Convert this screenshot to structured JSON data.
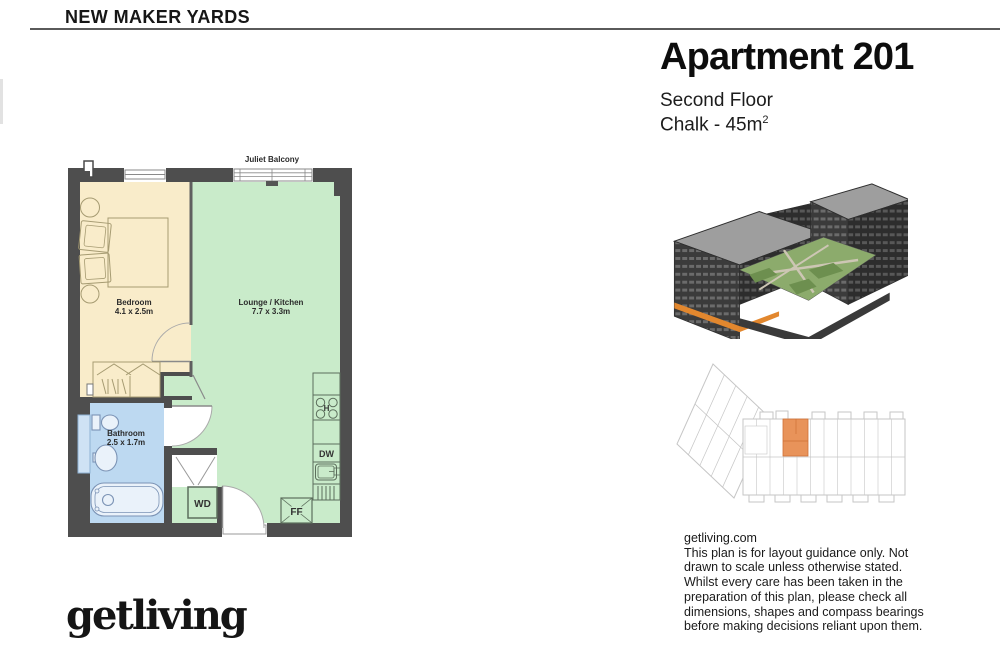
{
  "header": {
    "site_name": "NEW MAKER YARDS"
  },
  "apartment": {
    "title": "Apartment 201",
    "floor": "Second Floor",
    "unit_type": "Chalk - 45m",
    "area_exponent": "2"
  },
  "floor_plan": {
    "balcony_label": "Juliet Balcony",
    "rooms": [
      {
        "name": "Bedroom",
        "dimensions": "4.1 x 2.5m"
      },
      {
        "name": "Lounge / Kitchen",
        "dimensions": "7.7 x 3.3m"
      },
      {
        "name": "Bathroom",
        "dimensions": "2.5 x 1.7m"
      }
    ],
    "appliances": {
      "hob": "H",
      "dishwasher": "DW",
      "washer_dryer": "WD",
      "fridge_freezer": "FF"
    },
    "colors": {
      "bedroom_fill": "#f9ecca",
      "lounge_kitchen_fill": "#c9ebca",
      "bathroom_fill": "#bdd9f1",
      "wall": "#4e4e4e",
      "unit_highlight": "#e8935a"
    }
  },
  "footer": {
    "logo_text": "getliving"
  },
  "disclaimer": {
    "website": "getliving.com",
    "lines": [
      "This plan is for layout guidance only. Not",
      "drawn to scale unless otherwise stated.",
      "Whilst every care has been taken in the",
      "preparation of this plan, please check all",
      "dimensions, shapes and compass bearings",
      "before making decisions reliant upon them."
    ]
  }
}
